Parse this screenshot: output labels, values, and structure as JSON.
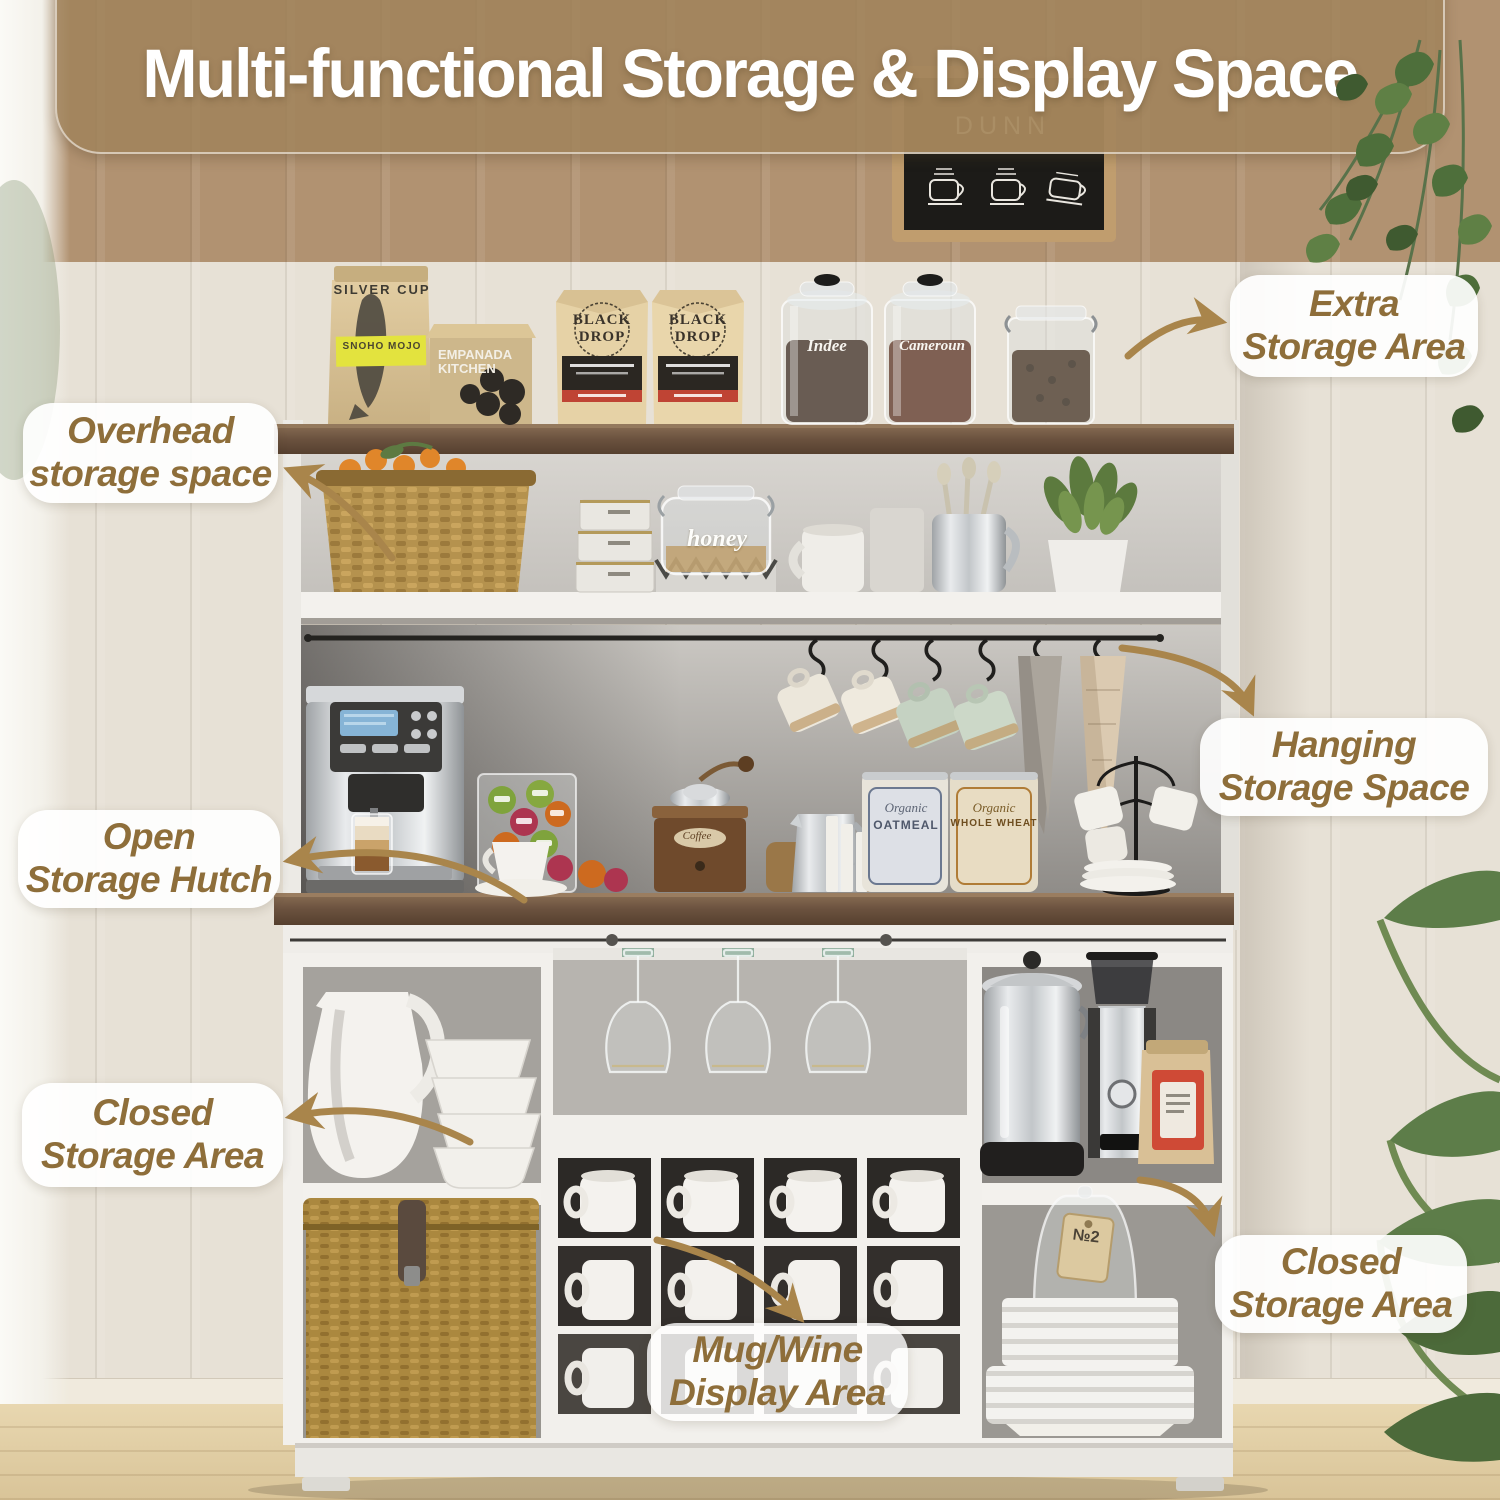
{
  "title": {
    "text": "Multi-functional Storage & Display Space"
  },
  "callouts": {
    "extra": {
      "line1": "Extra",
      "line2": "Storage Area"
    },
    "overhead": {
      "line1": "Overhead",
      "line2": "storage space"
    },
    "hanging": {
      "line1": "Hanging",
      "line2": "Storage Space"
    },
    "open_hutch": {
      "line1": "Open",
      "line2": "Storage Hutch"
    },
    "closed_left": {
      "line1": "Closed",
      "line2": "Storage Area"
    },
    "closed_right": {
      "line1": "Closed",
      "line2": "Storage Area"
    },
    "mug_wine": {
      "line1": "Mug/Wine",
      "line2": "Display Area"
    }
  },
  "chalkboard": {
    "line1": "IS",
    "line2": "DUNN"
  },
  "products": {
    "silver_cup": {
      "brand": "SILVER CUP",
      "label": "SNOHO MOJO"
    },
    "empanada": {
      "line1": "EMPANADA",
      "line2": "KITCHEN"
    },
    "black_drop": {
      "line1": "BLACK",
      "line2": "DROP"
    },
    "jar_left": "Indee",
    "jar_right": "Cameroun",
    "honey": "honey",
    "grinder": "Coffee",
    "oatmeal": {
      "script": "Organic",
      "name": "OATMEAL"
    },
    "wheat": {
      "script": "Organic",
      "name": "WHOLE WHEAT"
    },
    "cloche_tag": "№2"
  },
  "colors": {
    "accent_arrow": "#a9854b",
    "pill_text": "#8e6e3a",
    "pill_bg": "rgba(255,255,255,0.92)",
    "banner_bg": "rgba(160,130,90,0.82)",
    "cabinet_white": "#f2f0ec",
    "counter_wood": "#6f5948",
    "wall_beige": "#e7e0d4",
    "wall_top_tan": "#b19271"
  }
}
